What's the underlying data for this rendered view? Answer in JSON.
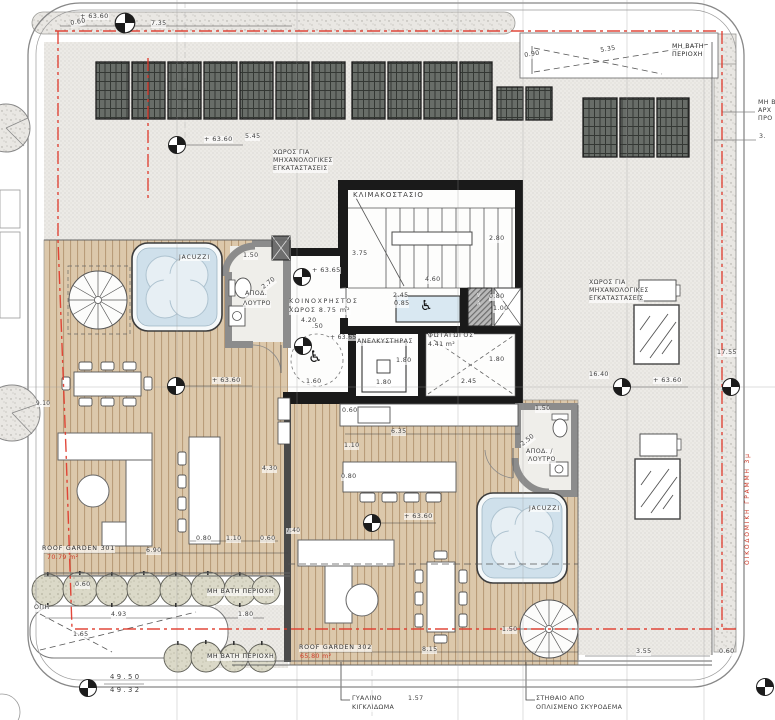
{
  "plan": {
    "type": "architectural roof-garden floor plan",
    "colors": {
      "deck_wood": "#dcc8ab",
      "deck_stripe": "#b99c79",
      "gravel": "#eceae6",
      "concrete_speckle": "#e9e7e3",
      "solar_panel": "#686d68",
      "wall_black": "#1a1a1a",
      "wall_gray": "#8c8c8c",
      "water": "#cfe0eb",
      "red_line": "#e0392b",
      "red_text": "#cf3a28",
      "lift_platform": "#d9e8f2"
    },
    "areas": {
      "roof_garden_301": "70.79 m²",
      "roof_garden_302": "65.80 m²",
      "common_space": "8.75 m²",
      "light_well": "4.41 m²"
    },
    "labels": [
      {
        "name": "level-top-left",
        "text": "+ 63.60",
        "x": 80,
        "y": 13,
        "size": 6.5
      },
      {
        "name": "dim-0-60-topleft",
        "text": "0.60",
        "x": 70,
        "y": 21,
        "rot": -10
      },
      {
        "name": "dim-7-35",
        "text": "7.35",
        "x": 151,
        "y": 21
      },
      {
        "name": "dim-0-90",
        "text": "0.90",
        "x": 524,
        "y": 53,
        "rot": -9
      },
      {
        "name": "dim-5-35-top",
        "text": "5.35",
        "x": 600,
        "y": 48,
        "rot": -9
      },
      {
        "name": "no-walk-top-1",
        "text": "ΜΗ ΒΑΤΗ",
        "x": 672,
        "y": 44,
        "cls": "dark"
      },
      {
        "name": "no-walk-top-2",
        "text": "ΠΕΡΙΟΧΗ",
        "x": 672,
        "y": 52,
        "cls": "dark"
      },
      {
        "name": "dim-5-45",
        "text": "5.45",
        "x": 245,
        "y": 134
      },
      {
        "name": "level-top-mid",
        "text": "+ 63.60",
        "x": 204,
        "y": 136,
        "size": 6.5
      },
      {
        "name": "mech-space-left-1",
        "text": "ΧΩΡΟΣ ΓΙΑ",
        "x": 273,
        "y": 150
      },
      {
        "name": "mech-space-left-2",
        "text": "ΜΗΧΑΝΟΛΟΓΙΚΕΣ",
        "x": 273,
        "y": 158
      },
      {
        "name": "mech-space-left-3",
        "text": "ΕΓΚΑΤΑΣΤΑΣΕΙΣ",
        "x": 273,
        "y": 166
      },
      {
        "name": "mech-space-right-1",
        "text": "ΧΩΡΟΣ ΓΙΑ",
        "x": 589,
        "y": 280
      },
      {
        "name": "mech-space-right-2",
        "text": "ΜΗΧΑΝΟΛΟΓΙΚΕΣ",
        "x": 589,
        "y": 288
      },
      {
        "name": "mech-space-right-3",
        "text": "ΕΓΚΑΤΑΣΤΑΣΕΙΣ",
        "x": 589,
        "y": 296
      },
      {
        "name": "room-stairwell",
        "text": "ΚΛΙΜΑΚΟΣΤΑΣΙΟ",
        "x": 353,
        "y": 192,
        "size": 7,
        "ls": 1
      },
      {
        "name": "dim-3-75",
        "text": "3.75",
        "x": 352,
        "y": 251
      },
      {
        "name": "dim-2-80",
        "text": "2.80",
        "x": 489,
        "y": 236
      },
      {
        "name": "dim-4-60",
        "text": "4.60",
        "x": 425,
        "y": 277
      },
      {
        "name": "dim-1-50-bath1",
        "text": "1.50",
        "x": 243,
        "y": 253
      },
      {
        "name": "jacuzzi-label-1",
        "text": "JACUZZI",
        "x": 179,
        "y": 255,
        "size": 6,
        "ls": 1
      },
      {
        "name": "level-63-65-a",
        "text": "+ 63.65",
        "x": 312,
        "y": 267,
        "size": 6.5
      },
      {
        "name": "room-bath1-1",
        "text": "ΑΠΟΔ.",
        "x": 245,
        "y": 291
      },
      {
        "name": "dim-2-70",
        "text": "2.70",
        "x": 261,
        "y": 286,
        "rot": -38
      },
      {
        "name": "room-bath1-2",
        "text": "ΛΟΥΤΡΟ",
        "x": 243,
        "y": 301
      },
      {
        "name": "room-common-1",
        "text": "ΚΟΙΝΟΧΡΗΣΤΟΣ",
        "x": 289,
        "y": 299,
        "ls": 1.6
      },
      {
        "name": "room-common-2",
        "text": "ΧΩΡΟΣ 8.75 m²",
        "x": 289,
        "y": 308,
        "ls": 1
      },
      {
        "name": "dim-4-20",
        "text": "4.20",
        "x": 301,
        "y": 318
      },
      {
        "name": "dim-50",
        "text": ".50",
        "x": 312,
        "y": 324
      },
      {
        "name": "dim-2-45-lift",
        "text": "2.45",
        "x": 393,
        "y": 293
      },
      {
        "name": "dim-0-85",
        "text": "0.85",
        "x": 394,
        "y": 301
      },
      {
        "name": "dim-0-80-shaft",
        "text": "0.80",
        "x": 489,
        "y": 294
      },
      {
        "name": "dim-1-00",
        "text": "1.00",
        "x": 493,
        "y": 306
      },
      {
        "name": "vent-letter-v",
        "text": "V",
        "x": 477,
        "y": 294,
        "size": 5,
        "color": "#f0f0f0",
        "cls": "nobg"
      },
      {
        "name": "vent-letter-a",
        "text": "A",
        "x": 477,
        "y": 302,
        "size": 5,
        "color": "#f0f0f0",
        "cls": "nobg"
      },
      {
        "name": "level-63-65-b",
        "text": "+ 63.65",
        "x": 330,
        "y": 335,
        "size": 6
      },
      {
        "name": "room-elevator",
        "text": "ΑΝΕΛΚΥΣΤΗΡΑΣ",
        "x": 357,
        "y": 339,
        "ls": 0.5
      },
      {
        "name": "room-lightwell-1",
        "text": "ΦΩΤΑΓΩΓΟΣ",
        "x": 428,
        "y": 333,
        "ls": 0.8
      },
      {
        "name": "room-lightwell-2",
        "text": "4.41 m²",
        "x": 428,
        "y": 342
      },
      {
        "name": "dim-1-80-a",
        "text": "1.80",
        "x": 396,
        "y": 358
      },
      {
        "name": "dim-1-80-b",
        "text": "1.80",
        "x": 489,
        "y": 357
      },
      {
        "name": "dim-1-80-c",
        "text": "1.80",
        "x": 376,
        "y": 380
      },
      {
        "name": "dim-2-45-b",
        "text": "2.45",
        "x": 461,
        "y": 379
      },
      {
        "name": "dim-1-60",
        "text": "1.60",
        "x": 306,
        "y": 379
      },
      {
        "name": "level-63-60-roof301",
        "text": "+ 63.60",
        "x": 212,
        "y": 377,
        "size": 6.5
      },
      {
        "name": "dim-9-10",
        "text": "9.10",
        "x": 36,
        "y": 401,
        "size": 5.8
      },
      {
        "name": "dim-0-60-counter",
        "text": "0.60",
        "x": 342,
        "y": 408
      },
      {
        "name": "dim-6-35",
        "text": "6.35",
        "x": 391,
        "y": 429
      },
      {
        "name": "dim-1-10-302",
        "text": "1.10",
        "x": 344,
        "y": 443
      },
      {
        "name": "dim-0-80-302",
        "text": "0.80",
        "x": 341,
        "y": 474
      },
      {
        "name": "dim-1-50-bath2",
        "text": "1.50",
        "x": 535,
        "y": 406
      },
      {
        "name": "dim-2-50",
        "text": "2.50",
        "x": 520,
        "y": 443,
        "rot": -38
      },
      {
        "name": "room-bath2-1",
        "text": "ΑΠΟΔ. /",
        "x": 526,
        "y": 449
      },
      {
        "name": "room-bath2-2",
        "text": "ΛΟΥΤΡΟ",
        "x": 528,
        "y": 457
      },
      {
        "name": "dim-4-30",
        "text": "4.30",
        "x": 262,
        "y": 466
      },
      {
        "name": "level-63-60-302",
        "text": "+ 63.60",
        "x": 404,
        "y": 513,
        "size": 6.5
      },
      {
        "name": "jacuzzi-label-2",
        "text": "JACUZZI",
        "x": 529,
        "y": 506,
        "size": 6,
        "ls": 1
      },
      {
        "name": "dim-16-40",
        "text": "16.40",
        "x": 589,
        "y": 372
      },
      {
        "name": "level-63-60-right",
        "text": "+ 63.60",
        "x": 653,
        "y": 377,
        "size": 6.5
      },
      {
        "name": "dim-17-55",
        "text": "17.55",
        "x": 717,
        "y": 350
      },
      {
        "name": "roof-garden-301-label",
        "text": "ROOF GARDEN 301",
        "x": 42,
        "y": 546,
        "cls": "dark",
        "ls": 0.8
      },
      {
        "name": "roof-garden-301-area",
        "text": "70.79 m²",
        "x": 47,
        "y": 555,
        "cls": "red"
      },
      {
        "name": "dim-6-90",
        "text": "6.90",
        "x": 146,
        "y": 548
      },
      {
        "name": "dim-0-80-bar",
        "text": "0.80",
        "x": 196,
        "y": 536
      },
      {
        "name": "dim-1-10-bar",
        "text": "1.10",
        "x": 226,
        "y": 536
      },
      {
        "name": "dim-0-60-bar",
        "text": "0.60",
        "x": 260,
        "y": 536
      },
      {
        "name": "dim-7-40",
        "text": "7.40",
        "x": 286,
        "y": 528,
        "size": 5.8
      },
      {
        "name": "dim-0-60-bush",
        "text": "0.60",
        "x": 75,
        "y": 582
      },
      {
        "name": "no-walk-a",
        "text": "ΜΗ ΒΑΤΗ ΠΕΡΙΟΧΗ",
        "x": 207,
        "y": 589,
        "cls": "dark",
        "ls": 0.5
      },
      {
        "name": "opening-label",
        "text": "ΟΠΗ",
        "x": 34,
        "y": 605
      },
      {
        "name": "dim-4-93",
        "text": "4.93",
        "x": 111,
        "y": 612
      },
      {
        "name": "dim-1-65",
        "text": "1.65",
        "x": 73,
        "y": 632
      },
      {
        "name": "dim-1-80-bl",
        "text": "1.80",
        "x": 238,
        "y": 612
      },
      {
        "name": "no-walk-b",
        "text": "ΜΗ ΒΑΤΗ ΠΕΡΙΟΧΗ",
        "x": 207,
        "y": 654,
        "cls": "dark",
        "ls": 0.5
      },
      {
        "name": "roof-garden-302-label",
        "text": "ROOF GARDEN 302",
        "x": 299,
        "y": 645,
        "cls": "dark",
        "ls": 0.8
      },
      {
        "name": "roof-garden-302-area",
        "text": "65.80 m²",
        "x": 300,
        "y": 654,
        "cls": "red"
      },
      {
        "name": "dim-8-15",
        "text": "8.15",
        "x": 422,
        "y": 647
      },
      {
        "name": "dim-1-50-spiral",
        "text": "1.50",
        "x": 502,
        "y": 627
      },
      {
        "name": "dim-3-55",
        "text": "3.55",
        "x": 636,
        "y": 649
      },
      {
        "name": "dim-0-60-br",
        "text": "0.60",
        "x": 719,
        "y": 649
      },
      {
        "name": "level-49-50",
        "text": "49.50",
        "x": 110,
        "y": 674,
        "size": 6.8,
        "ls": 2.4,
        "cls": "nobg"
      },
      {
        "name": "level-49-32",
        "text": "49.32",
        "x": 110,
        "y": 687,
        "size": 6.8,
        "ls": 2.4,
        "cls": "nobg"
      },
      {
        "name": "glass-railing-1",
        "text": "ΓΥΑΛΙΝΟ",
        "x": 352,
        "y": 696
      },
      {
        "name": "glass-railing-2",
        "text": "ΚΙΓΚΛΙΔΩΜΑ",
        "x": 352,
        "y": 705
      },
      {
        "name": "dim-1-57",
        "text": "1.57",
        "x": 408,
        "y": 696
      },
      {
        "name": "parapet-note-1",
        "text": "ΣΤΗΘΑΙΟ ΑΠΟ",
        "x": 536,
        "y": 696
      },
      {
        "name": "parapet-note-2",
        "text": "ΟΠΛΙΣΜΕΝΟ ΣΚΥΡΟΔΕΜΑ",
        "x": 536,
        "y": 705
      },
      {
        "name": "building-line-note",
        "text": "ΟΙΚΟΔΟΜΙΚΗ ΓΡΑΜΜΗ 3μ",
        "x": 745,
        "y": 565,
        "rot": -90,
        "cls": "red",
        "ls": 1.8,
        "size": 6
      },
      {
        "name": "no-walk-right-1",
        "text": "ΜΗ Β",
        "x": 758,
        "y": 100
      },
      {
        "name": "no-walk-right-2",
        "text": "ΑΡΧ",
        "x": 758,
        "y": 108
      },
      {
        "name": "no-walk-right-3",
        "text": "ΠΡΟ",
        "x": 758,
        "y": 116
      },
      {
        "name": "dim-3-right",
        "text": "3.",
        "x": 759,
        "y": 134
      },
      {
        "name": "wheelchair-icon",
        "text": "♿",
        "x": 420,
        "y": 299,
        "size": 14,
        "cls": "icon"
      },
      {
        "name": "wheelchair-icon",
        "text": "♿",
        "x": 308,
        "y": 349,
        "size": 16,
        "cls": "icon"
      }
    ]
  }
}
